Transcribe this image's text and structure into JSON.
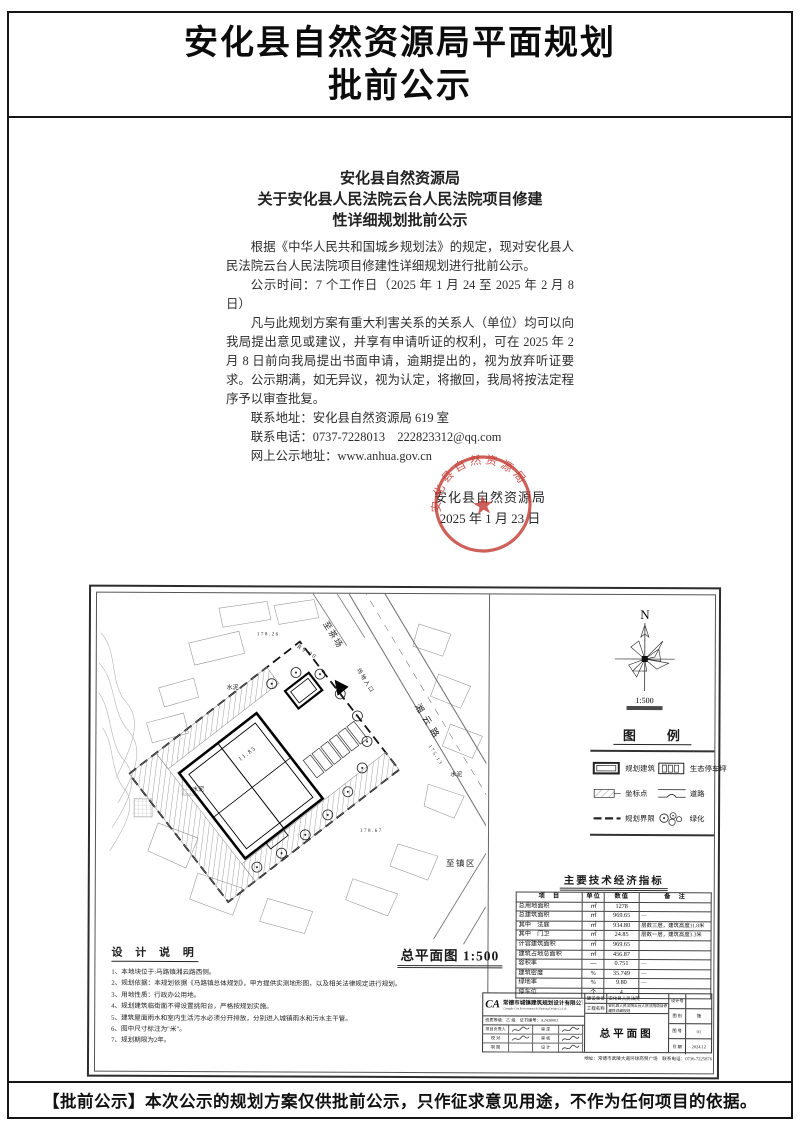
{
  "page": {
    "title_line1": "安化县自然资源局平面规划",
    "title_line2": "批前公示",
    "footer": "【批前公示】本次公示的规划方案仅供批前公示，只作征求意见用途，不作为任何项目的依据。"
  },
  "notice": {
    "heading": [
      "安化县自然资源局",
      "关于安化县人民法院云台人民法院项目修建",
      "性详细规划批前公示"
    ],
    "para1": "根据《中华人民共和国城乡规划法》的规定，现对安化县人民法院云台人民法院项目修建性详细规划进行批前公示。",
    "para2": "公示时间：7 个工作日（2025 年 1 月 24 至 2025 年 2 月 8 日）",
    "para3": "凡与此规划方案有重大利害关系的关系人（单位）均可以向我局提出意见或建议，并享有申请听证的权利，可在 2025 年 2 月 8 日前向我局提出书面申请，逾期提出的，视为放弃听证要求。公示期满，如无异议，视为认定，将撤回，我局将按法定程序予以审查批复。",
    "contact_address": "联系地址：安化县自然资源局 619 室",
    "contact_phone": "联系电话：0737-7228013　222823312@qq.com",
    "website": "网上公示地址：www.anhua.gov.cn",
    "seal_arc_text": "安化县自然资源局",
    "org_line": "安化县自然资源局",
    "date_line": "2025 年 1 月 23 日",
    "seal_color": "#c03028"
  },
  "drawing": {
    "north_label": "N",
    "scale": "1:500",
    "plan_title": "总平面图 1:500",
    "legend": {
      "title": "图　例",
      "items": [
        {
          "symbol": "building",
          "label": "规划建筑"
        },
        {
          "symbol": "parking",
          "label": "生态停车坪"
        },
        {
          "symbol": "coord",
          "label": "坐标点"
        },
        {
          "symbol": "road",
          "label": "道路"
        },
        {
          "symbol": "boundary",
          "label": "规划界限"
        },
        {
          "symbol": "green",
          "label": "绿化"
        }
      ]
    },
    "indicators": {
      "title": "主要技术经济指标",
      "headers": [
        "项　目",
        "单位",
        "数值",
        "备　注"
      ],
      "rows": [
        [
          "总用地面积",
          "㎡",
          "1278",
          ""
        ],
        [
          "总建筑面积",
          "㎡",
          "969.65",
          "—"
        ],
        [
          "其中　法庭",
          "㎡",
          "934.80",
          "层数三层，建筑高度11.8米"
        ],
        [
          "其中　门卫",
          "㎡",
          "24.85",
          "层数一层，建筑高度3.3米"
        ],
        [
          "计容建筑面积",
          "㎡",
          "969.65",
          ""
        ],
        [
          "建筑占地总面积",
          "㎡",
          "456.87",
          ""
        ],
        [
          "容积率",
          "—",
          "0.751",
          "—"
        ],
        [
          "建筑密度",
          "%",
          "35.749",
          "—"
        ],
        [
          "绿地率",
          "%",
          "9.80",
          "—"
        ],
        [
          "停车位",
          "个",
          "4",
          ""
        ]
      ]
    },
    "design_notes": {
      "title": "设 计 说 明",
      "items": [
        "1、本地块位于:马路镇湘云路西侧。",
        "2、规划依据：本规划依据《马路镇总体规划》，甲方提供实测地形图，以及相关法律规定进行规划。",
        "3、用地性质：行政办公用地。",
        "4、规划建筑临街面不得设置挑阳台，严格按规划实施。",
        "5、建筑屋面雨水和室内生活污水必须分开排放，分别进入城镇雨水和污水主干管。",
        "6、图中尺寸标注为\"米\"。",
        "7、规划期限为2年。"
      ]
    },
    "map_labels": [
      {
        "text": "至茶场",
        "x": 224,
        "y": 30,
        "r": 58,
        "s": 8.5
      },
      {
        "text": "湘 云 路",
        "x": 316,
        "y": 112,
        "r": 58,
        "s": 9
      },
      {
        "text": "至镇区",
        "x": 348,
        "y": 272,
        "r": 0,
        "s": 8.5
      },
      {
        "text": "水泥",
        "x": 94,
        "y": 198,
        "r": 0,
        "s": 6
      },
      {
        "text": "水泥",
        "x": 128,
        "y": 96,
        "r": 0,
        "s": 6
      },
      {
        "text": "水泥",
        "x": 352,
        "y": 182,
        "r": 0,
        "s": 6
      },
      {
        "text": "R9.00",
        "x": 198,
        "y": 54,
        "r": 32,
        "s": 6
      },
      {
        "text": "场地入口",
        "x": 258,
        "y": 76,
        "r": 58,
        "s": 5.5
      },
      {
        "text": "175.13",
        "x": 330,
        "y": 152,
        "r": 58,
        "s": 5
      },
      {
        "text": "178.26",
        "x": 158,
        "y": 42,
        "r": 0,
        "s": 5
      },
      {
        "text": "11.85",
        "x": 142,
        "y": 168,
        "r": -38,
        "s": 6
      },
      {
        "text": "178.67",
        "x": 262,
        "y": 238,
        "r": 0,
        "s": 5
      }
    ],
    "titleblock": {
      "logo": "CA",
      "company_cn": "常德市城镇建筑规划设计有限公司",
      "company_en": "Changde City Environment & Planning Design Co.Ltd",
      "grade_line": "资质等级：乙 级　证书编号：A2430003",
      "owner_label": "建设单位",
      "owner": "安化县人民法院",
      "project_label": "工程名称",
      "project": "安化县人民法院云台人民法院项目修建性详细规划",
      "sheet_name": "总平面图",
      "sign_rows": [
        [
          "项目负责人",
          "审 定"
        ],
        [
          "校 对",
          "审 核"
        ],
        [
          "制 图",
          "设 计"
        ]
      ],
      "info_rows": [
        [
          "设计号",
          ""
        ],
        [
          "图 别",
          "施"
        ],
        [
          "图 号",
          "01"
        ],
        [
          "日 期",
          "2024.12"
        ]
      ],
      "address_line": "地址：常德市武陵大道环球商贸广场　联系电话：0736-7225876"
    }
  }
}
